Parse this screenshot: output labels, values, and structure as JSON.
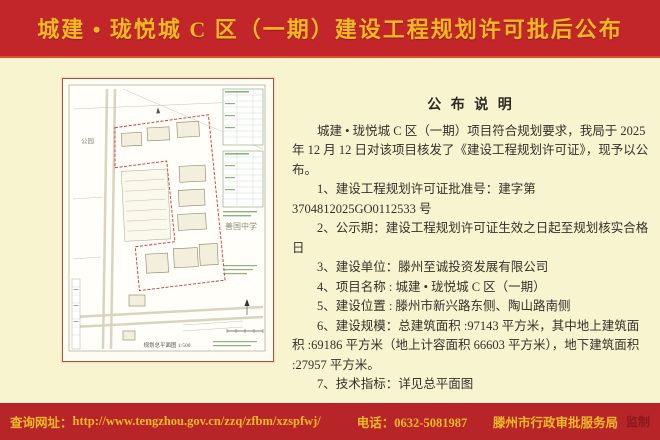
{
  "colors": {
    "header_red": "#c2262a",
    "footer_red": "#b82529",
    "gold_text": "#f2b822",
    "body_cream": "#f9f4d0",
    "seal_dark_red": "#871a1d",
    "plan_boundary_red": "#c93434",
    "plan_table_green": "#649a58"
  },
  "header": {
    "title": "城建 • 珑悦城 C 区（一期）建设工程规划许可批后公布"
  },
  "notice": {
    "title": "公 布 说 明",
    "intro": "城建 • 珑悦城 C 区（一期）项目符合规划要求，我局于 2025 年 12 月 12 日对该项目核发了《建设工程规划许可证》，现予以公布。",
    "items": [
      "1、建设工程规划许可证批准号：建字第 3704812025GO0112533 号",
      "2、公示期：建设工程规划许可证生效之日起至规划核实合格日",
      "3、建设单位：滕州至诚投资发展有限公司",
      "4、项目名称 : 城建 • 珑悦城 C 区（一期）",
      "5、建设位置 : 滕州市新兴路东侧、陶山路南侧",
      "6、建设规模：总建筑面积 :97143 平方米，其中地上建筑面积 :69186 平方米（地上计容面积 66603 平方米），地下建筑面积 :27957 平方米。",
      "7、技术指标：详见总平面图"
    ]
  },
  "site_plan": {
    "label_park": "公园",
    "label_school": "善国中学",
    "caption": "规划总平面图 1:500"
  },
  "footer": {
    "url_label": "查询网址：",
    "url": "http://www.tengzhou.gov.cn/zzq/zfbm/xzspfwj/",
    "phone": "电话：0632-5081987",
    "agency": "滕州市行政审批服务局",
    "seal": "监制"
  }
}
